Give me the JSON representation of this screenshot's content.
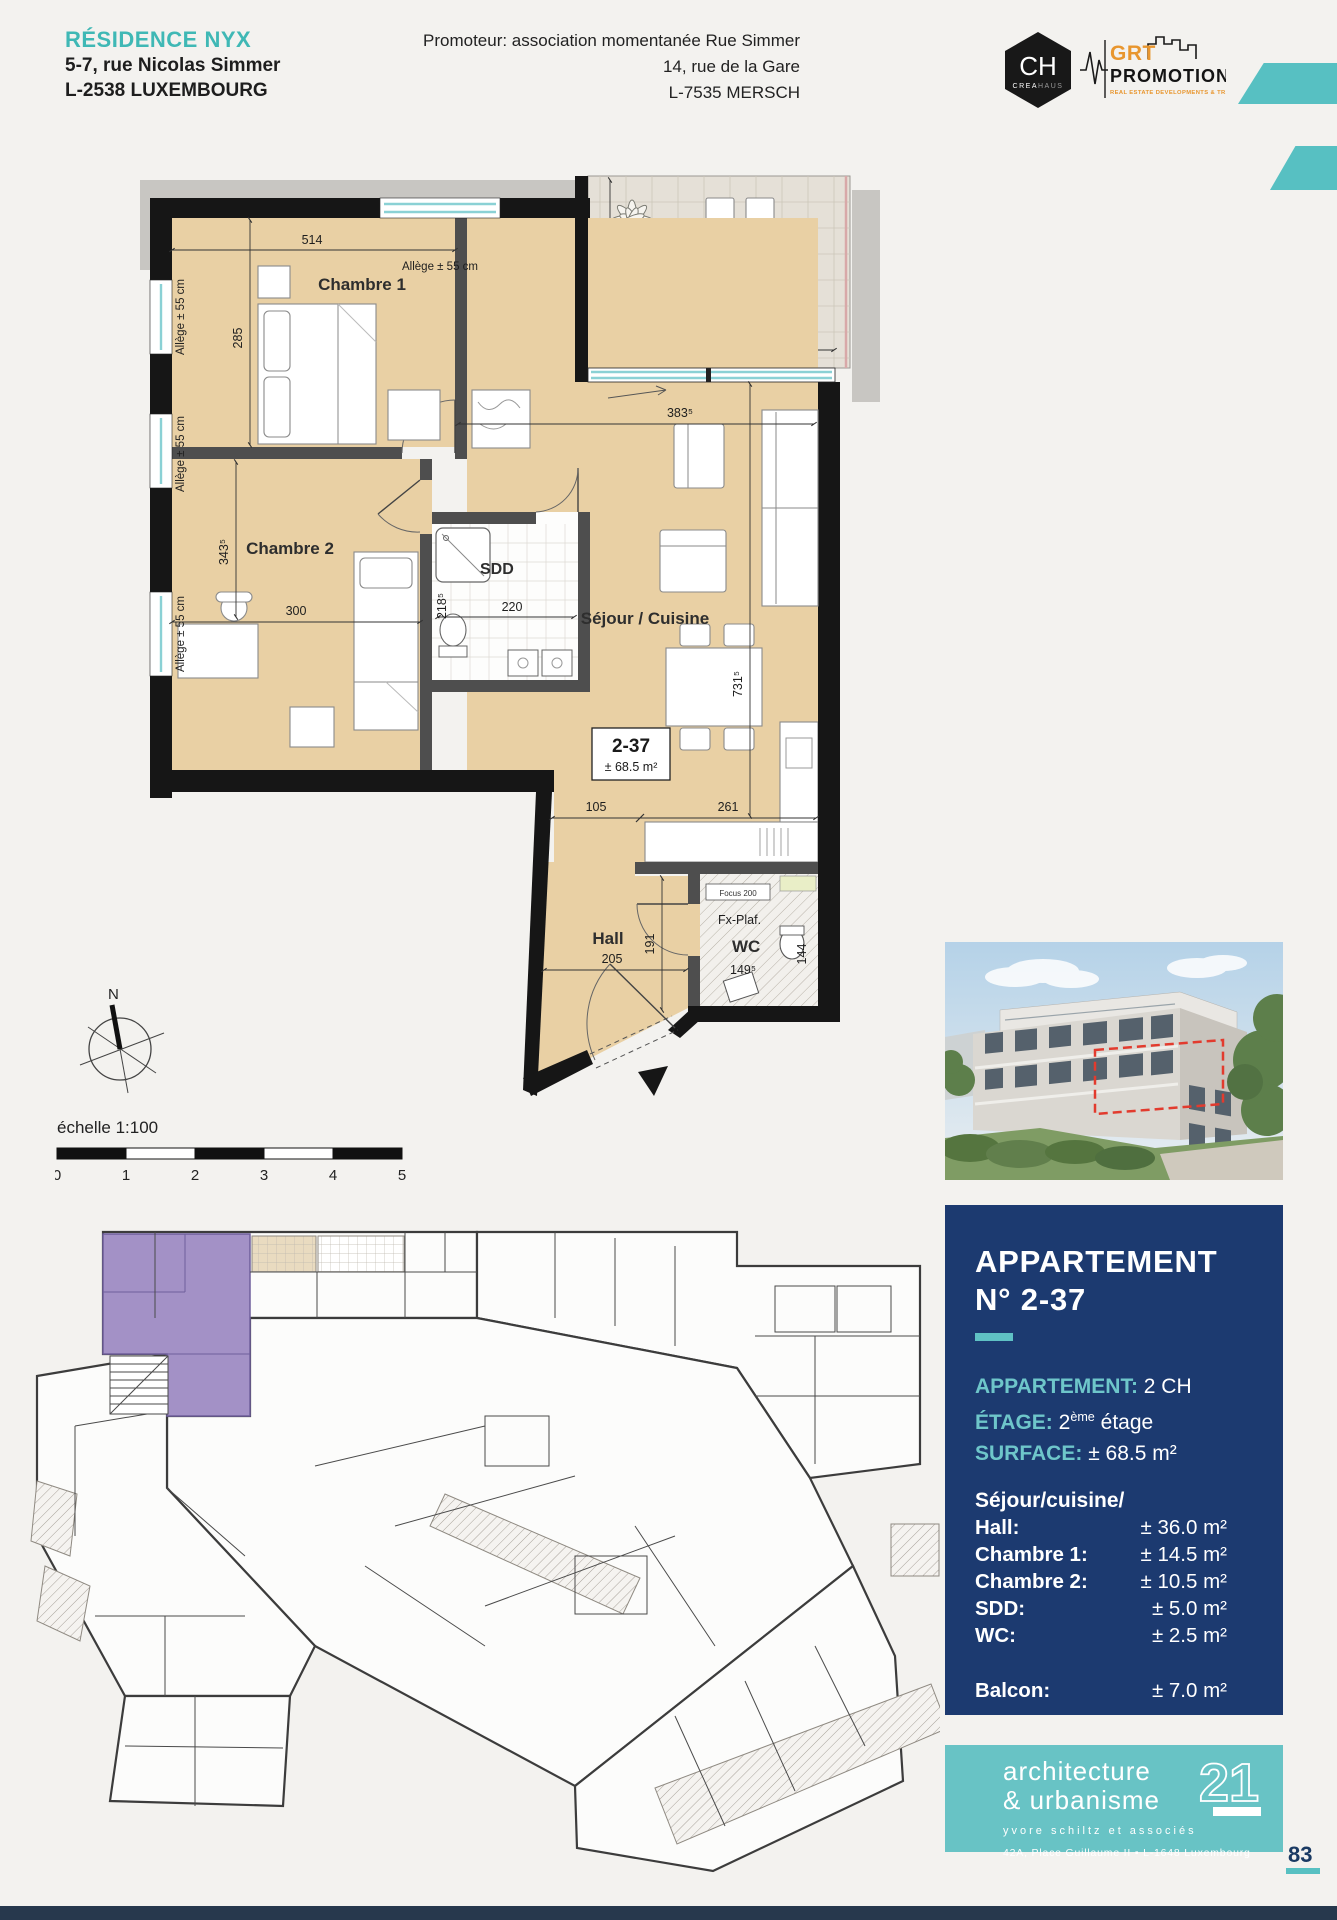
{
  "header": {
    "residence": "RÉSIDENCE NYX",
    "address1": "5-7, rue Nicolas Simmer",
    "address2": "L-2538 LUXEMBOURG",
    "promoter1": "Promoteur: association momentanée Rue Simmer",
    "promoter2": "14, rue de la Gare",
    "promoter3": "L-7535 MERSCH"
  },
  "logos": {
    "creahaus_initials": "CH",
    "creahaus_name1": "CREA",
    "creahaus_name2": "HAUS",
    "grt_name": "GRT",
    "grt_sub": "PROMOTIONS",
    "grt_tagline": "REAL ESTATE DEVELOPMENTS & TRANSACTIONS"
  },
  "plan": {
    "rooms": {
      "chambre1": "Chambre 1",
      "chambre2": "Chambre 2",
      "sdd": "SDD",
      "sejour": "Séjour / Cuisine",
      "hall": "Hall",
      "wc": "WC",
      "balcon": "Balcon"
    },
    "unit": {
      "number": "2-37",
      "area": "± 68.5 m²"
    },
    "notes": {
      "allege": "Allège ± 55 cm",
      "fxplaf": "Fx-Plaf.",
      "focus": "Focus 200"
    },
    "dims": {
      "d514": "514",
      "d285": "285",
      "d352": "352",
      "d197": "197",
      "d3835": "383⁵",
      "d3435": "343⁵",
      "d300": "300",
      "d2185": "218⁵",
      "d220": "220",
      "d7315": "731⁵",
      "d105": "105",
      "d261": "261",
      "d205": "205",
      "d191": "191",
      "d1495": "149⁵",
      "d144": "144"
    },
    "compass_north": "N",
    "scale_label": "échelle 1:100",
    "scale_ticks": [
      "0",
      "1",
      "2",
      "3",
      "4",
      "5"
    ]
  },
  "panel": {
    "title1": "APPARTEMENT",
    "title2": "N° 2-37",
    "spec_appartement_label": "APPARTEMENT:",
    "spec_appartement_value": "2 CH",
    "spec_etage_label": "ÉTAGE:",
    "spec_etage_num": "2",
    "spec_etage_sup": "ème",
    "spec_etage_rest": "étage",
    "spec_surface_label": "SURFACE:",
    "spec_surface_value": "± 68.5 m²",
    "surfaces_title": "Séjour/cuisine/",
    "surfaces": [
      {
        "label": "Hall:",
        "value": "± 36.0 m²"
      },
      {
        "label": "Chambre 1:",
        "value": "± 14.5 m²"
      },
      {
        "label": "Chambre 2:",
        "value": "± 10.5 m²"
      },
      {
        "label": "SDD:",
        "value": "± 5.0 m²"
      },
      {
        "label": "WC:",
        "value": "± 2.5 m²"
      }
    ],
    "balcon_label": "Balcon:",
    "balcon_value": "± 7.0 m²"
  },
  "arch": {
    "line1": "architecture",
    "line2": "& urbanisme",
    "number": "21",
    "subtitle": "yvore schiltz et associés",
    "address": "42A, Place Guillaume II  ▪  L-1648 Luxembourg"
  },
  "footer": {
    "page_number": "83"
  }
}
